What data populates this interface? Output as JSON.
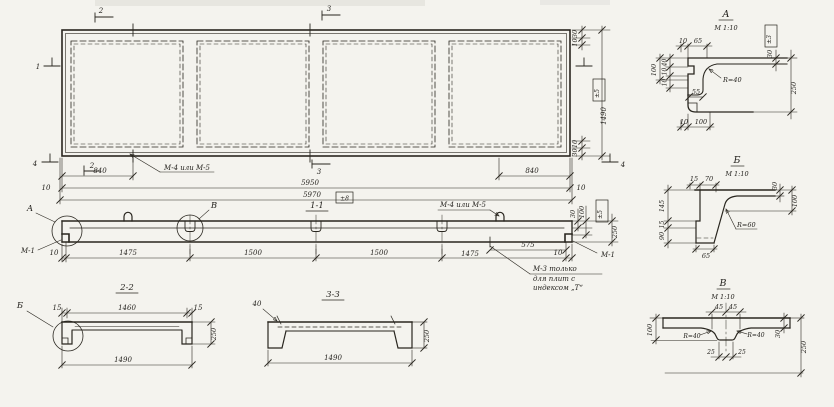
{
  "plan": {
    "markers": {
      "s1_left": "1",
      "s2_top": "2",
      "s3_top": "3",
      "s4_left": "4",
      "s2_bottom": "2",
      "s3_bottom": "3",
      "s4_right": "4"
    },
    "weld_label": "М-4 или М-5",
    "dims": {
      "edge_840_left": "840",
      "edge_840_right": "840",
      "len_5950": "5950",
      "len_5970": "5970",
      "tol_len": "±8",
      "off_10_left": "10",
      "off_10_right": "10",
      "top_30": "30",
      "top_10": "10",
      "width_1490": "1490",
      "tol_width": "±5",
      "bot_10": "10",
      "bot_30": "30"
    }
  },
  "section_1_1": {
    "title": "1-1",
    "callout_a": "А",
    "callout_b": "В",
    "mark_m1_left": "М-1",
    "mark_m1_right": "М-1",
    "weld_label": "М-4 или М-5",
    "note_line1": "М-3 только",
    "note_line2": "для плит с",
    "note_line3": "индексом „Т“",
    "dims": {
      "d10_left": "10",
      "d1475_left": "1475",
      "d1500_a": "1500",
      "d1500_b": "1500",
      "d1475_right": "1475",
      "d575": "575",
      "d10_right": "10",
      "flange_30": "30",
      "rib_100": "100",
      "tol": "±5",
      "depth_250": "250"
    }
  },
  "section_2_2": {
    "title": "2-2",
    "callout_b": "Б",
    "dims": {
      "d15_left": "15",
      "d1460": "1460",
      "d15_right": "15",
      "d1490": "1490",
      "depth_250": "250"
    }
  },
  "section_3_3": {
    "title": "3-3",
    "dims": {
      "d40": "40",
      "d1490": "1490",
      "depth_250": "250"
    }
  },
  "detail_a": {
    "title": "А",
    "scale": "М 1:10",
    "tol": "±3",
    "dims": {
      "top_10": "10",
      "top_65": "65",
      "flange_30": "30",
      "depth_250": "250",
      "radius": "R=40",
      "left_100": "100",
      "left_40": "40",
      "left_10a": "10",
      "left_10b": "10",
      "stem_55": "55",
      "bot_10": "10",
      "bot_100": "100"
    }
  },
  "detail_b": {
    "title": "Б",
    "scale": "М 1:10",
    "dims": {
      "top_15": "15",
      "top_70": "70",
      "flange_30": "30",
      "rib_100": "100",
      "radius": "R=60",
      "left_145": "145",
      "left_15": "15",
      "left_90": "90",
      "bot_65": "65"
    }
  },
  "detail_v": {
    "title": "В",
    "scale": "М 1:10",
    "dims": {
      "top_45_l": "45",
      "top_45_r": "45",
      "left_100": "100",
      "radius_l": "R=40",
      "radius_r": "R=40",
      "flange_30": "30",
      "depth_250": "250",
      "bot_25_l": "25",
      "bot_25_r": "25"
    }
  }
}
